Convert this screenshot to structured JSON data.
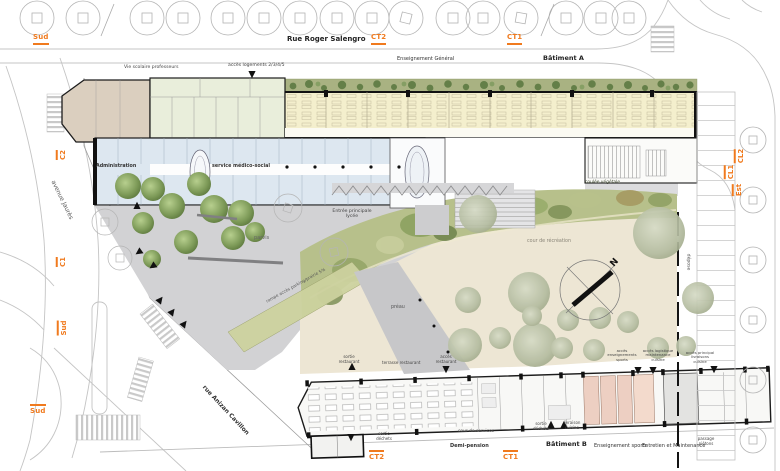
{
  "plan": {
    "streets": {
      "top": "Rue Roger Salengro",
      "west": "avenue Jaurès",
      "south": "rue Anizan Cavillon"
    },
    "transport": {
      "sud": "Sud",
      "ct2": "CT2",
      "ct1": "CT1",
      "c2": "C2",
      "c1": "C1",
      "cl2": "CL2",
      "cl1": "CL1",
      "est": "Est"
    },
    "buildings": {
      "a": {
        "name": "Bâtiment A",
        "enseignement_general": "Enseignement Général",
        "vie_scolaire": "Vie scolaire professeurs",
        "acces_logements": "accès logements 2/3/4/5",
        "administration": "Administration",
        "service_medico_social": "service médico-social"
      },
      "b": {
        "name": "Bâtiment B",
        "demi_pension": "Demi-pension",
        "enseignement_sports": "Enseignement sports",
        "entretien_maintenance": "Entretien et Maintenance",
        "sortie_restaurant": "sortie\nrestaurant",
        "terrasse_restaurant": "terrasse restaurant",
        "acces_restaurant": "accès\nrestaurant",
        "acces_enseignements_sports": "accès\nenseignements\nsports",
        "acces_logistique": "accès logistique\nmaintenance\ncuisine",
        "acces_principal_livraisons": "accès principal\nlivraisons\ncuisine",
        "cour_de_services": "cour de services",
        "sortie_dechets": "sortie\ndéchets",
        "livraison_cuisine": "livraison\ncuisine"
      }
    },
    "site": {
      "parvis": "parvis",
      "entree_principale": "Entrée principale\nlycée",
      "rampe": "rampe accès parking/prairie 5%",
      "coulee_vegetale": "coulée végétale",
      "cour_recreation": "cour de récréation",
      "preau": "préau",
      "depose": "dépose",
      "passage_pietons": "passage\npiétons"
    },
    "compass": {
      "north": "N"
    },
    "colors": {
      "accent_orange": "#f07a1e",
      "plaza_gray": "#d2d2d4",
      "courtyard_beige": "#ede6d4",
      "coulee_green": "#b7c08b",
      "roof_band_green": "#a9b282",
      "classrooms_yellow": "#f4efcd",
      "admin_blue": "#dde7f0",
      "rooms_green": "#e9eedb",
      "corner_beige": "#dbcfbf",
      "vestiaires_pink": "#edcfc2"
    }
  }
}
